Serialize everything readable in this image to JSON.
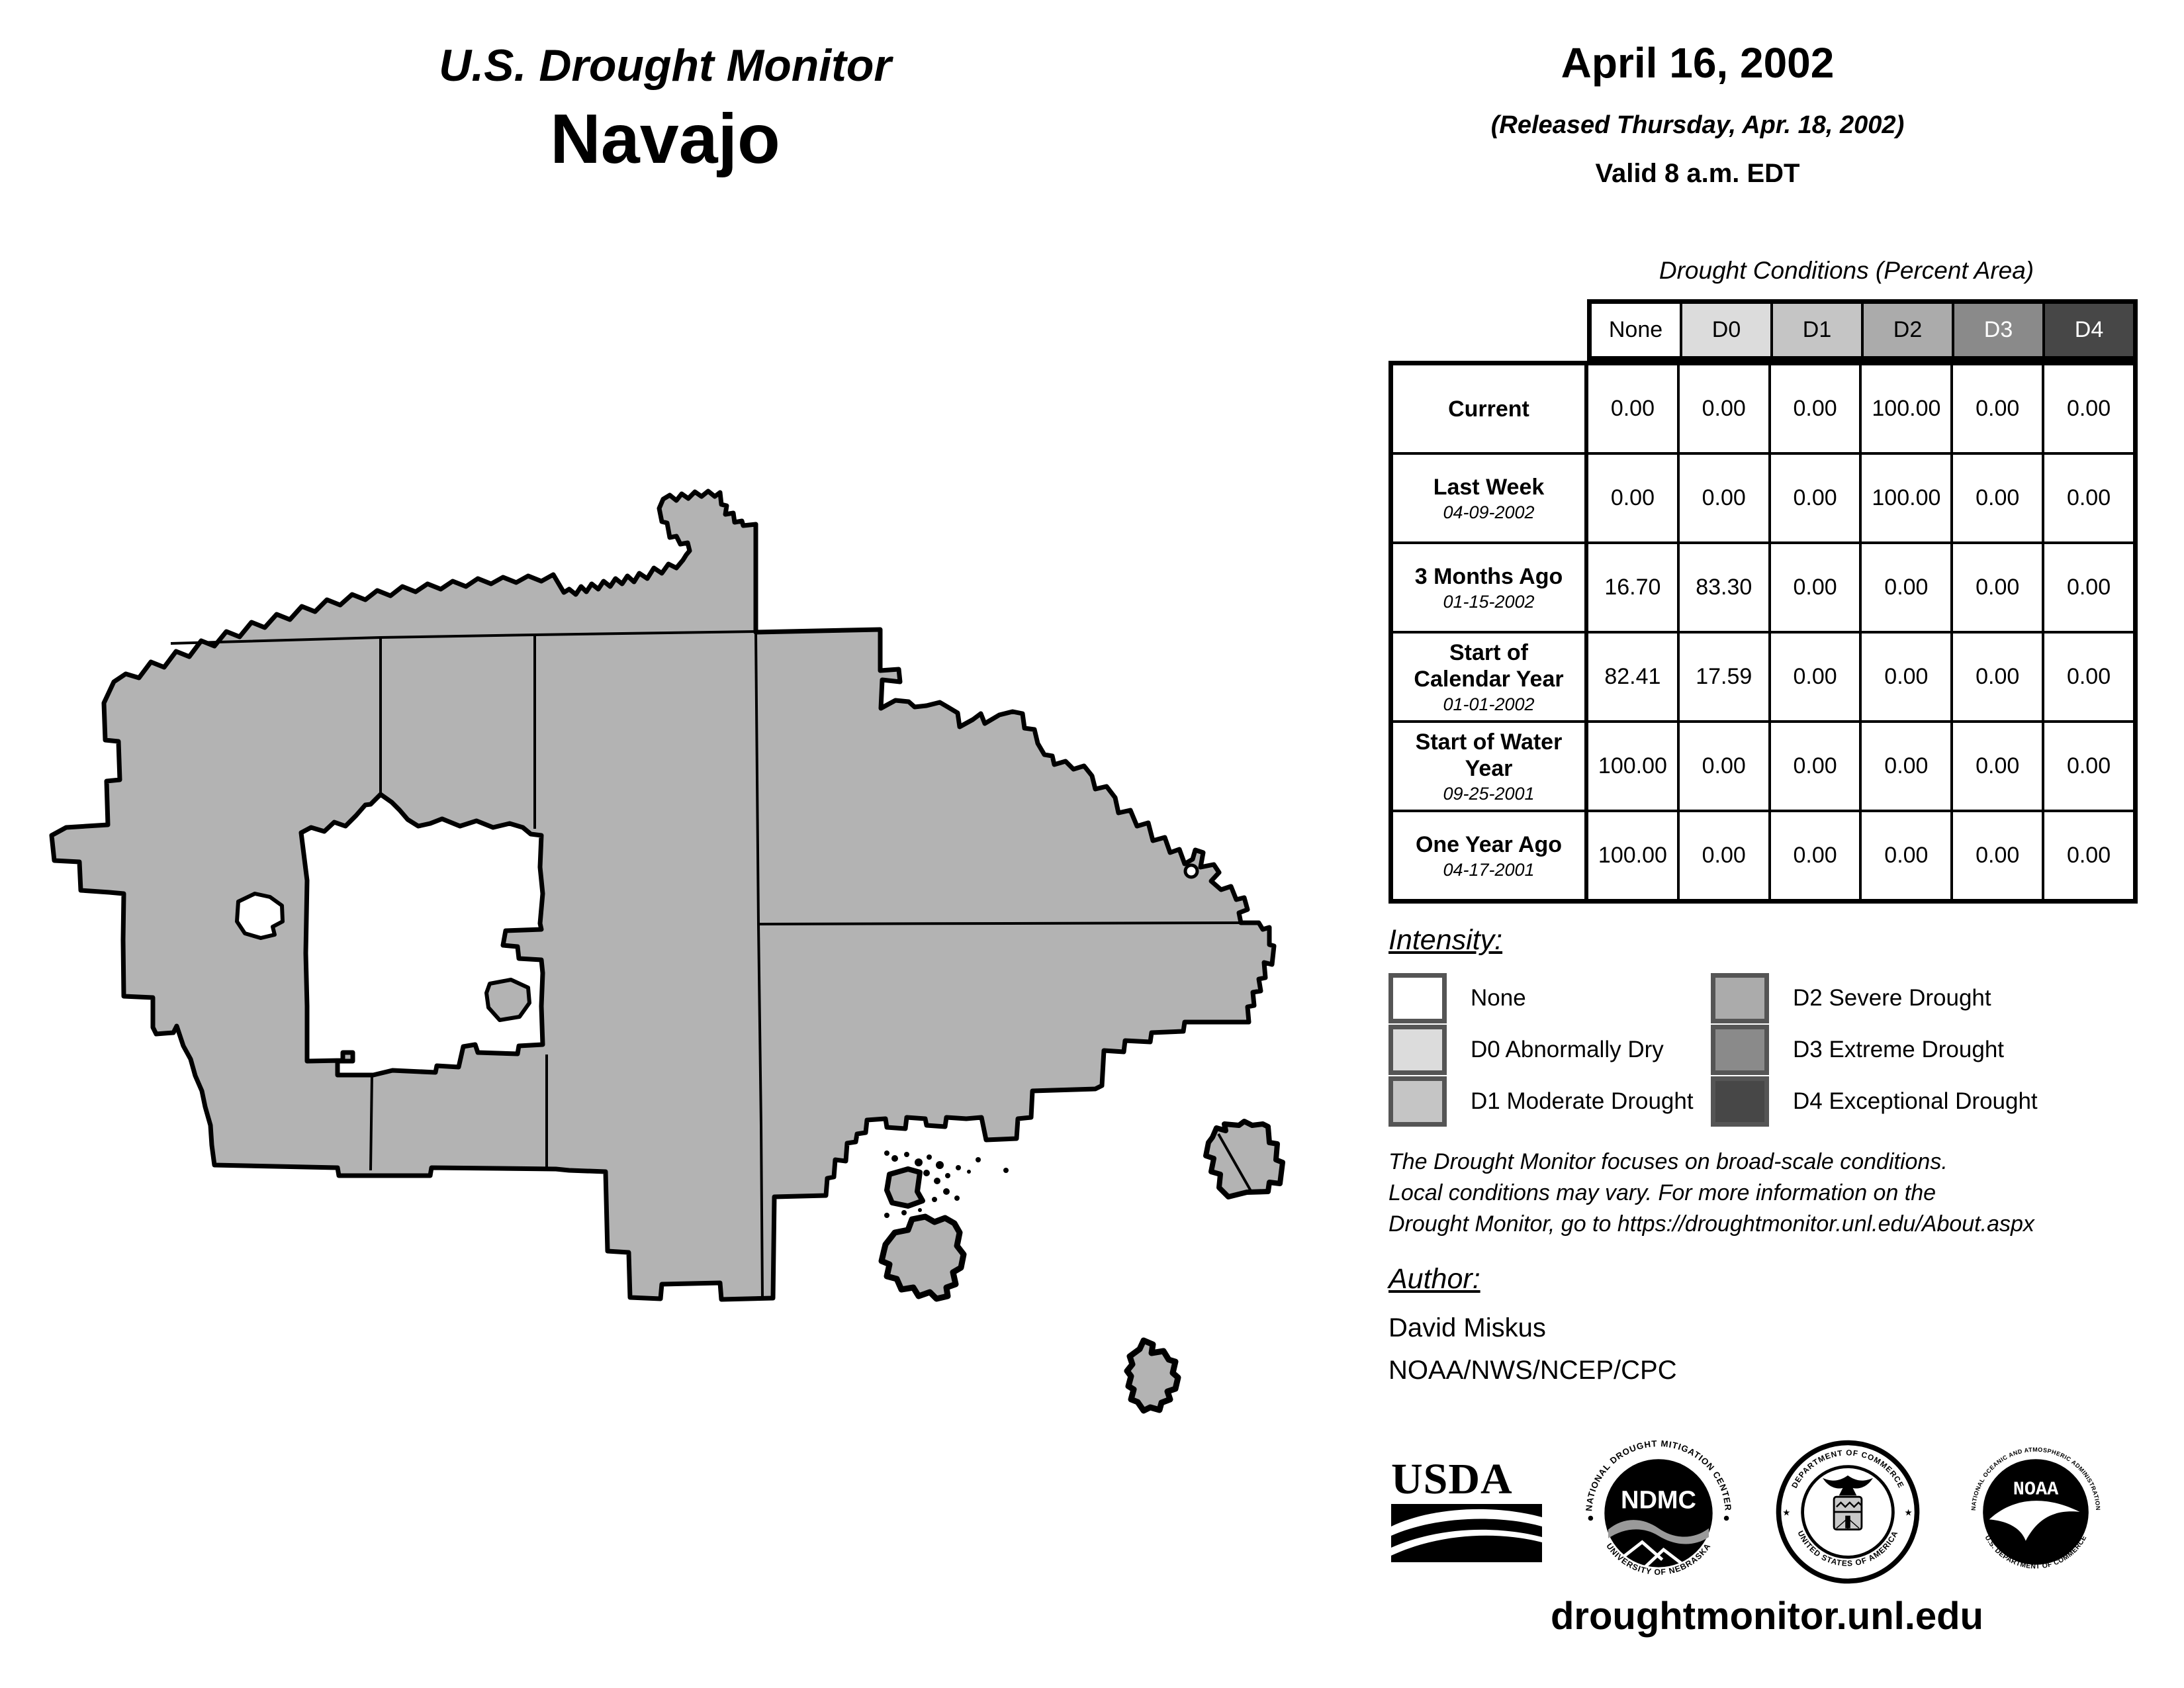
{
  "header": {
    "title": "U.S. Drought Monitor",
    "region": "Navajo"
  },
  "release": {
    "date": "April 16, 2002",
    "released": "(Released Thursday, Apr. 18, 2002)",
    "valid": "Valid 8 a.m. EDT"
  },
  "table": {
    "title": "Drought Conditions (Percent Area)",
    "columns": [
      "None",
      "D0",
      "D1",
      "D2",
      "D3",
      "D4"
    ],
    "header_colors": [
      "#ffffff",
      "#dcdcdc",
      "#c5c5c5",
      "#ababab",
      "#8a8a8a",
      "#474747"
    ],
    "header_text_colors": [
      "#000000",
      "#000000",
      "#000000",
      "#000000",
      "#ffffff",
      "#ffffff"
    ],
    "rows": [
      {
        "label": "Current",
        "sublabel": "",
        "values": [
          "0.00",
          "0.00",
          "0.00",
          "100.00",
          "0.00",
          "0.00"
        ]
      },
      {
        "label": "Last Week",
        "sublabel": "04-09-2002",
        "values": [
          "0.00",
          "0.00",
          "0.00",
          "100.00",
          "0.00",
          "0.00"
        ]
      },
      {
        "label": "3 Months Ago",
        "sublabel": "01-15-2002",
        "values": [
          "16.70",
          "83.30",
          "0.00",
          "0.00",
          "0.00",
          "0.00"
        ]
      },
      {
        "label": "Start of Calendar Year",
        "sublabel": "01-01-2002",
        "values": [
          "82.41",
          "17.59",
          "0.00",
          "0.00",
          "0.00",
          "0.00"
        ]
      },
      {
        "label": "Start of Water Year",
        "sublabel": "09-25-2001",
        "values": [
          "100.00",
          "0.00",
          "0.00",
          "0.00",
          "0.00",
          "0.00"
        ]
      },
      {
        "label": "One Year Ago",
        "sublabel": "04-17-2001",
        "values": [
          "100.00",
          "0.00",
          "0.00",
          "0.00",
          "0.00",
          "0.00"
        ]
      }
    ]
  },
  "legend": {
    "title": "Intensity:",
    "items": [
      {
        "label": "None",
        "color": "#ffffff"
      },
      {
        "label": "D0 Abnormally Dry",
        "color": "#dcdcdc"
      },
      {
        "label": "D1 Moderate Drought",
        "color": "#c5c5c5"
      },
      {
        "label": "D2 Severe Drought",
        "color": "#ababab"
      },
      {
        "label": "D3 Extreme Drought",
        "color": "#8a8a8a"
      },
      {
        "label": "D4 Exceptional Drought",
        "color": "#474747"
      }
    ]
  },
  "disclaimer": {
    "line1": "The Drought Monitor focuses on broad-scale conditions.",
    "line2": "Local conditions may vary. For more information on the",
    "line3": "Drought Monitor, go to https://droughtmonitor.unl.edu/About.aspx"
  },
  "author": {
    "title": "Author:",
    "name": "David Miskus",
    "org": "NOAA/NWS/NCEP/CPC"
  },
  "footer": {
    "url": "droughtmonitor.unl.edu"
  },
  "logos": {
    "usda": "USDA",
    "ndmc": "NDMC",
    "ndmc_ring": "NATIONAL DROUGHT MITIGATION CENTER",
    "ndmc_bottom": "UNIVERSITY OF NEBRASKA",
    "doc_ring_top": "DEPARTMENT OF COMMERCE",
    "doc_ring_bottom": "UNITED STATES OF AMERICA",
    "noaa": "NOAA",
    "noaa_ring_top": "NATIONAL OCEANIC AND ATMOSPHERIC ADMINISTRATION",
    "noaa_ring_bottom": "U.S. DEPARTMENT OF COMMERCE"
  },
  "map": {
    "fill": "#b3b3b3",
    "description": "Navajo Nation — 100% D2 Severe Drought"
  }
}
